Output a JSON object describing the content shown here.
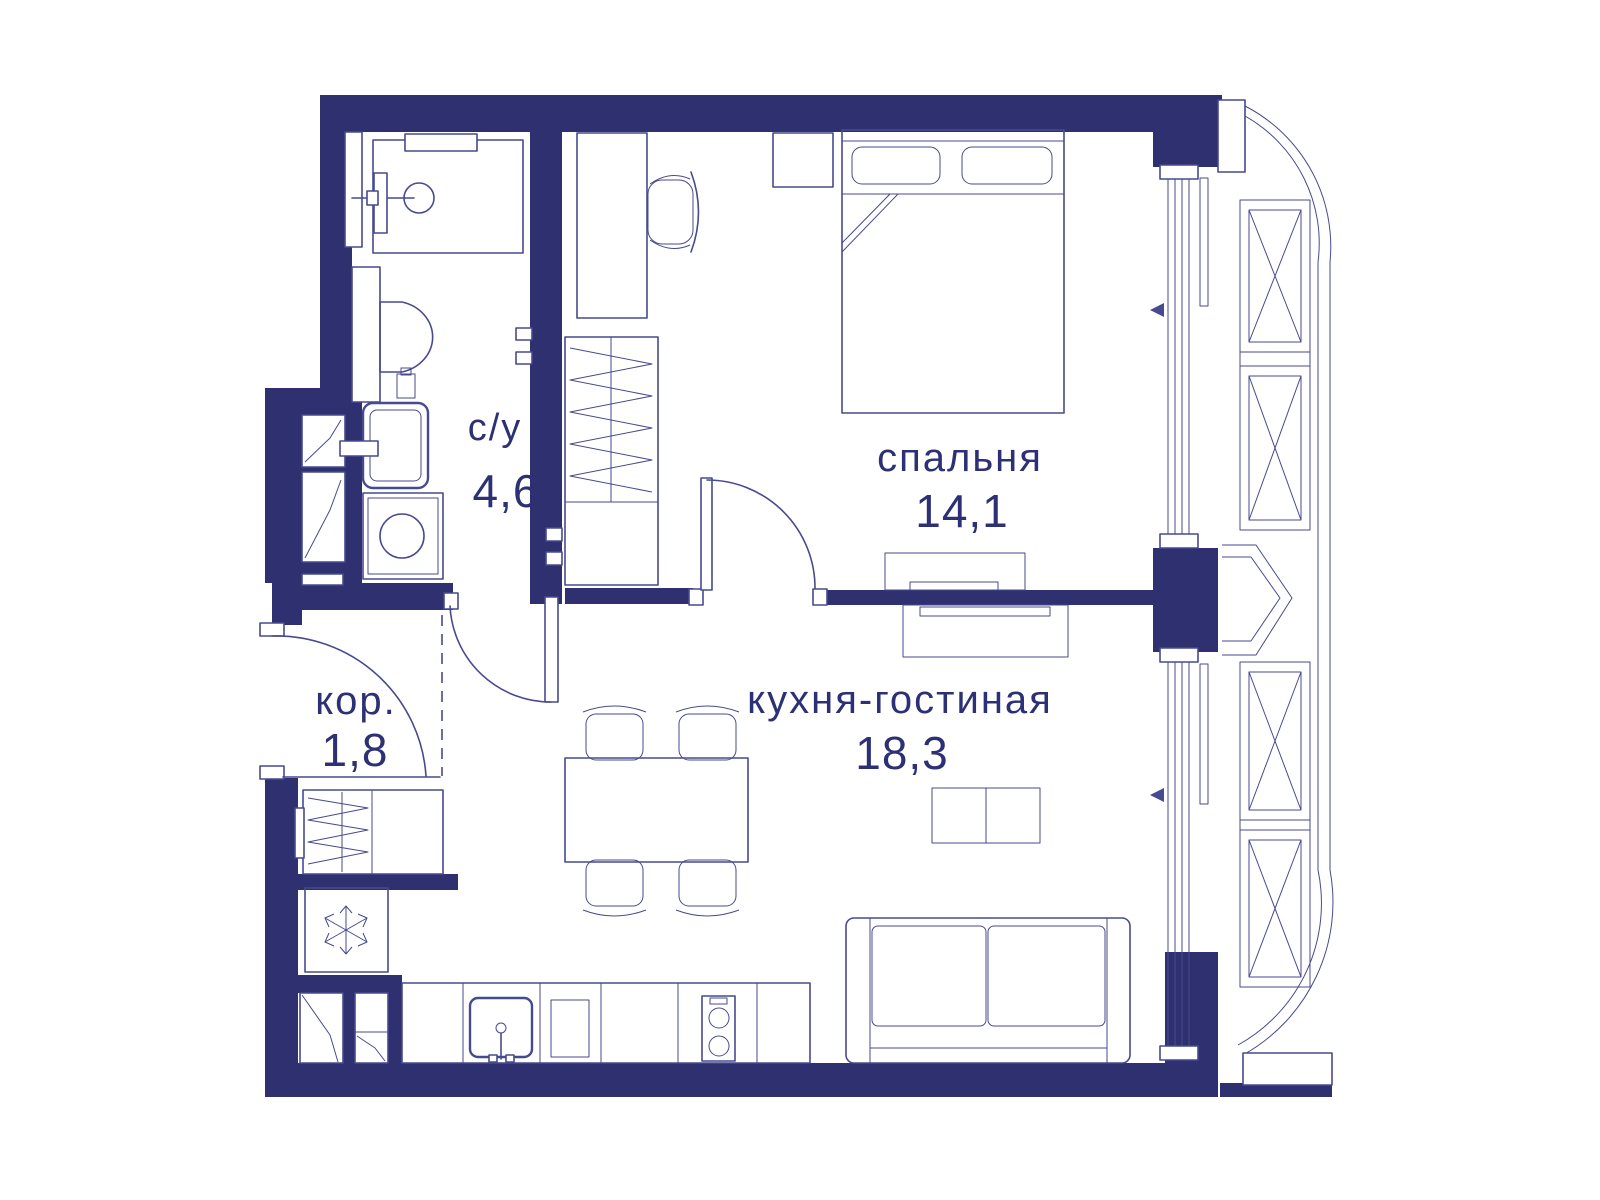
{
  "plan": {
    "colors": {
      "wall": "#2e306f",
      "line": "#474a8e",
      "label": "#2e3076",
      "background": "#ffffff"
    },
    "rooms": [
      {
        "id": "bathroom",
        "label": "с/у",
        "area": "4,6"
      },
      {
        "id": "bedroom",
        "label": "спальня",
        "area": "14,1"
      },
      {
        "id": "kitchen-living",
        "label": "кухня-гостиная",
        "area": "18,3"
      },
      {
        "id": "corridor",
        "label": "кор.",
        "area": "1,8"
      }
    ]
  }
}
